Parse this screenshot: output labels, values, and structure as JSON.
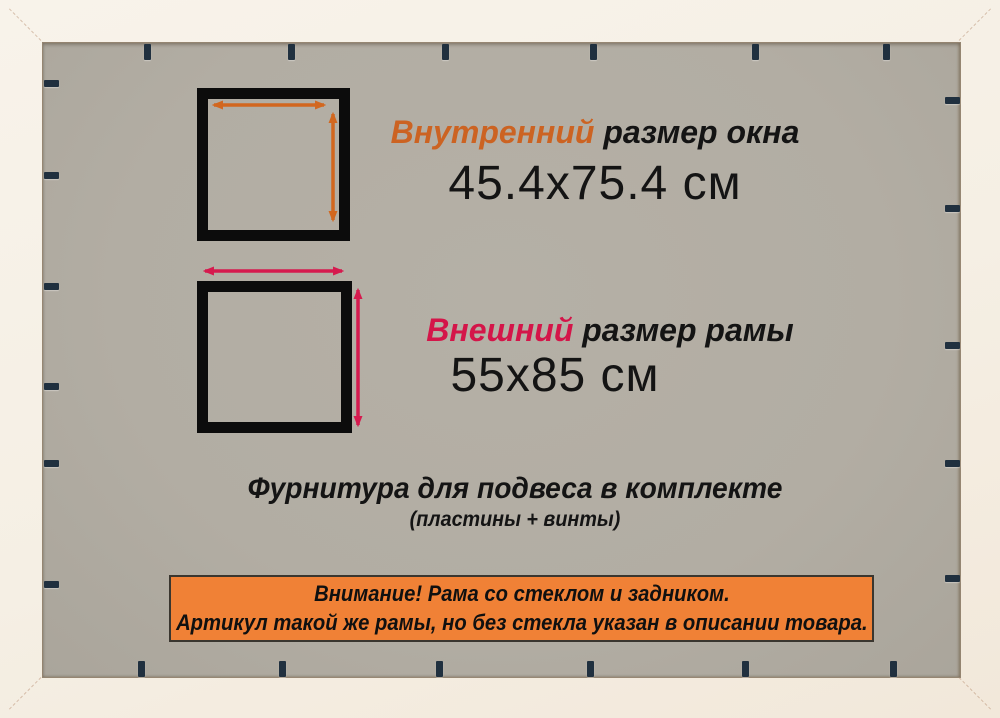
{
  "frame_diagram": {
    "inner_size": {
      "label_accent": "Внутренний",
      "label_rest": " размер окна",
      "value": "45.4x75.4 см"
    },
    "outer_size": {
      "label_accent": "Внешний",
      "label_rest": " размер рамы",
      "value": "55x85 см"
    },
    "hardware_note": {
      "line1": "Фурнитура для подвеса в комплекте",
      "line2": "(пластины + винты)"
    },
    "notice_banner": {
      "line1": "Внимание! Рама со стеклом и задником.",
      "line2": "Артикул такой же рамы, но без стекла указан в описании товара."
    }
  },
  "colors": {
    "accent_orange": "#cc6322",
    "arrow_orange": "#d2671f",
    "accent_crimson": "#d41549",
    "arrow_crimson": "#d61a4e",
    "banner_fill": "#f08136",
    "banner_border": "#3a362f",
    "staple": "#20303f",
    "square_border": "#0c0c0c",
    "backing_grey": "#b2ada3",
    "frame_white": "#f5efe4",
    "text_black": "#141414"
  },
  "staples": {
    "top_x": [
      144,
      288,
      442,
      590,
      752,
      883
    ],
    "bottom_x": [
      138,
      279,
      436,
      587,
      742,
      890
    ],
    "left_y": [
      80,
      172,
      283,
      383,
      460,
      581
    ],
    "right_y": [
      97,
      205,
      342,
      460,
      575
    ]
  }
}
